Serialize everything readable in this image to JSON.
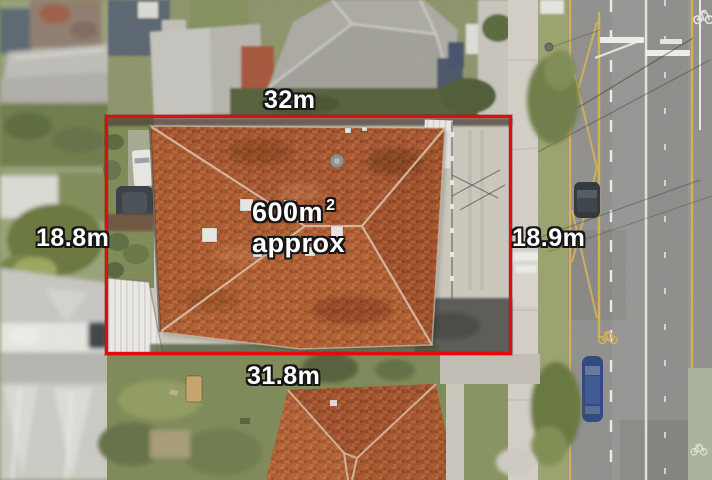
{
  "page": {
    "title": "Aerial property photograph with site dimensions"
  },
  "measurements": {
    "top": "32m",
    "left": "18.8m",
    "right": "18.9m",
    "bottom": "31.8m"
  },
  "area": {
    "value": "600m",
    "superscript": "2",
    "qualifier": "approx"
  },
  "overlay": {
    "boundary_color": "#e60b0b",
    "label_fill": "#ffffff",
    "label_outline": "#161616"
  },
  "scene": {
    "description": "Top-down aerial photo: terracotta hip-roof house inside red site boundary, neighbouring rooftops left and top, footpath, nature strip and multi-lane road with yellow and white markings on the right, second terracotta roof below",
    "palette": {
      "roof_terracotta": "#a85a32",
      "roof_grey": "#a9a7a1",
      "grass": "#7b8757",
      "concrete": "#c9c5bb",
      "asphalt": "#8d8d8b",
      "lane_yellow": "#d4af52",
      "marking_white": "#ebebe7",
      "tree_green": "#67743f"
    },
    "icons": [
      "bicycle-lane-icon",
      "satellite-dish-icon"
    ]
  }
}
